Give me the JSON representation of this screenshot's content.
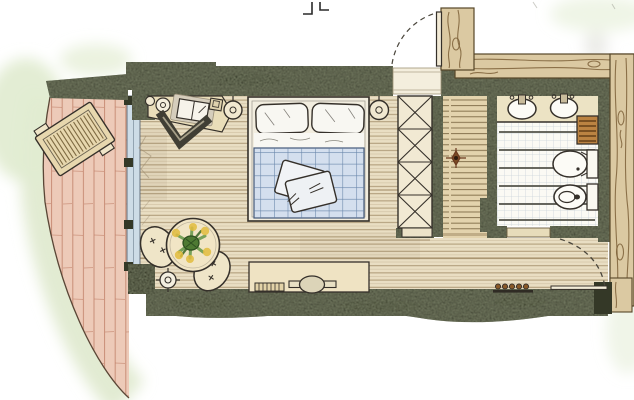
{
  "image": {
    "kind": "Hand-drawn hotel suite floor plan",
    "medium": "ink and colored pencil sketch, top-down plan view",
    "width_px": 634,
    "height_px": 400
  },
  "palette": {
    "wall": "#4b4f3c",
    "wallShadow": "#343827",
    "woodCladding": "#dbc9a2",
    "woodGrain": "#7c6038",
    "deck": "#edcab8",
    "deckLine": "#bf7e66",
    "lawn": "#e2ecd2",
    "bedroomFloor": "#e9dec3",
    "floorLine": "#8f7850",
    "hallFloor": "#e3d3ad",
    "hallLine": "#6f5b38",
    "glass": "#cddce7",
    "glassFrame": "#5a6472",
    "linen": "#f8f7f2",
    "duvet": "#d4dfee",
    "duvetCheck": "#5d7ca3",
    "furnitureCream": "#efe5c8",
    "outline": "#35302a",
    "tileFloor": "#fbfaf4",
    "tileGrid": "#ccd3db",
    "tileAccent": "#53534a",
    "towelRail": "#bb8342",
    "plantGreen": "#5a9140",
    "plantDark": "#3f6a2c",
    "blossomYellow": "#e2bd3e",
    "ink": "#2a2a2a"
  },
  "areas": [
    {
      "id": "terrace",
      "label": "Terrace deck",
      "items": [
        "sun-lounger"
      ]
    },
    {
      "id": "bedroom",
      "label": "Bedroom",
      "items": [
        "double-bed",
        "pillows",
        "checked-duvet",
        "throw-cushions",
        "bedside-lamp-left",
        "bedside-lamp-right",
        "desk",
        "open-book",
        "desk-chair",
        "wall-sconce",
        "round-table",
        "potted-plant",
        "tub-chair-1",
        "tub-chair-2",
        "ceiling-spotlight",
        "tv-sideboard",
        "television",
        "soundbar",
        "curtain"
      ]
    },
    {
      "id": "dressing-hall",
      "label": "Dressing hall",
      "items": [
        "wardrobe-cross-shelves",
        "floor-ornament"
      ]
    },
    {
      "id": "bathroom",
      "label": "Bathroom",
      "items": [
        "vanity-counter",
        "washbasin-left",
        "washbasin-right",
        "towel-rail",
        "toilet",
        "bidet"
      ]
    },
    {
      "id": "corridor",
      "label": "Corridor",
      "items": [
        "shoe-rack",
        "door-threshold"
      ]
    }
  ],
  "openings": [
    {
      "id": "entrance-door",
      "type": "hinged door with dashed swing arc",
      "position": "top"
    },
    {
      "id": "bathroom-door",
      "type": "hinged door with dashed swing arc",
      "position": "bottom-right"
    },
    {
      "id": "glass-front",
      "type": "fixed glazing to terrace",
      "position": "left"
    }
  ],
  "counts": {
    "washbasins": 2,
    "toilets": 1,
    "bidets": 1,
    "beds": 1,
    "sun_loungers": 1,
    "chairs": 3,
    "tables": 1,
    "wardrobe_sections": 4
  }
}
